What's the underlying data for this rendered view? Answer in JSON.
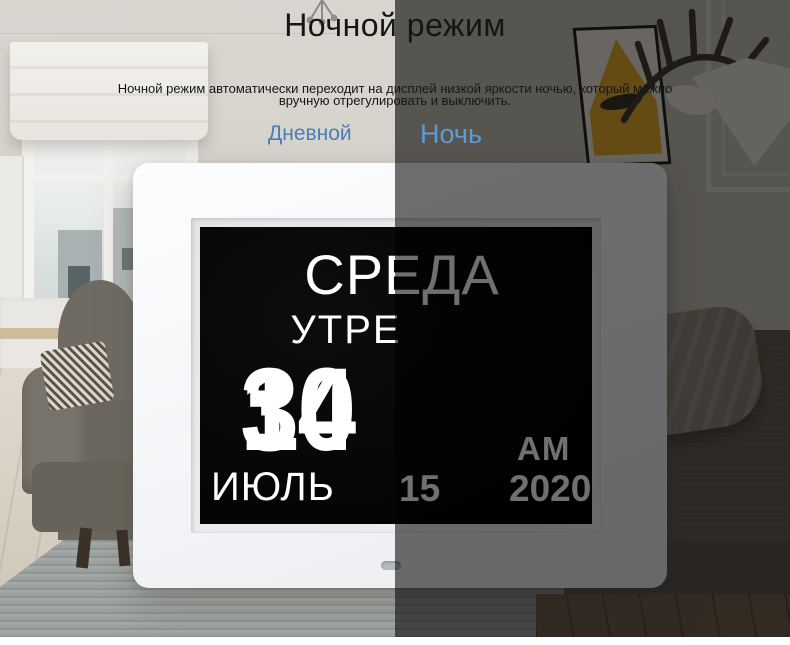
{
  "header": {
    "title": "Ночной режим",
    "description_line1": "Ночной режим автоматически переходит на дисплей низкой яркости ночью, который можно",
    "description_line2": "вручную отрегулировать и выключить."
  },
  "mode_tabs": {
    "day_label": "Дневной",
    "night_label": "Ночь"
  },
  "clock_display": {
    "weekday": "СРЕДА",
    "day_part": "УТРЕ",
    "hour": "10",
    "separator": ":",
    "minute": "34",
    "meridiem": "AM",
    "month": "ИЮЛЬ",
    "date": "15",
    "year": "2020"
  },
  "colors": {
    "day_tab_text": "#4a7db8",
    "night_tab_text": "#5d9bd3",
    "title_text": "#151515",
    "clock_frame": "#f3f4f6",
    "clock_screen_bg": "#060606",
    "clock_text_bright": "#ffffff",
    "clock_text_dimmed": "#6f6f6f",
    "night_overlay": "rgba(0,0,0,0.56)"
  }
}
